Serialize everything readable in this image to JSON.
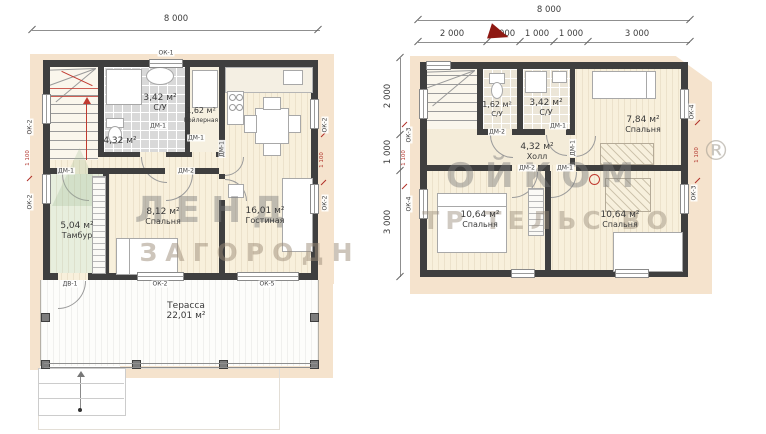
{
  "plan1": {
    "dim_total": "8 000",
    "rooms": {
      "su": {
        "area": "3,42 м²",
        "name": "С/У"
      },
      "boiler": {
        "area": "1,62 м²",
        "name": "Бойлерная"
      },
      "hall": {
        "area": "4,32 м²"
      },
      "bedroom": {
        "area": "8,12 м²",
        "name": "Спальня"
      },
      "living": {
        "area": "16,01 м²",
        "name": "Гостиная"
      },
      "tambur": {
        "area": "5,04 м²",
        "name": "Тамбур"
      },
      "terrace": {
        "name": "Терасса",
        "area": "22,01 м²"
      }
    }
  },
  "plan2": {
    "dim_total": "8 000",
    "top_dims": [
      "2 000",
      "1 000",
      "1 000",
      "1 000",
      "3 000"
    ],
    "side_dims": [
      "2 000",
      "1 000",
      "3 000"
    ],
    "rooms": {
      "su_left": {
        "area": "1,62 м²",
        "name": "С/У"
      },
      "su_right": {
        "area": "3,42 м²",
        "name": "С/У"
      },
      "bedroom_top": {
        "area": "7,84 м²",
        "name": "Спальня"
      },
      "hall": {
        "area": "4,32 м²",
        "name": "Холл"
      },
      "bedroom_left": {
        "area": "10,64 м²",
        "name": "Спальня"
      },
      "bedroom_right": {
        "area": "10,64 м²",
        "name": "Спальня"
      }
    }
  },
  "tags": {
    "ok1": "ОК-1",
    "ok2": "ОК-2",
    "ok3": "ОК-3",
    "ok4": "ОК-4",
    "ok5": "ОК-5",
    "dm1": "ДМ-1",
    "dm2": "ДМ-2",
    "dv1": "ДВ-1",
    "red_dim": "1 100"
  },
  "watermark": {
    "left1": "ЛЕНД",
    "left2": "ЗАГОРОДН",
    "right1": "ОЙКОМ",
    "right2": "ТР ТЕЛЬС ВО",
    "reg": "®"
  },
  "colors": {
    "wall": "#3f3f3f",
    "floor": "#f8f0dc",
    "overhang": "#f5e3cd",
    "tile": "#d9d9d9",
    "tambur": "#e7eedd",
    "red_annotation": "#b03028"
  }
}
